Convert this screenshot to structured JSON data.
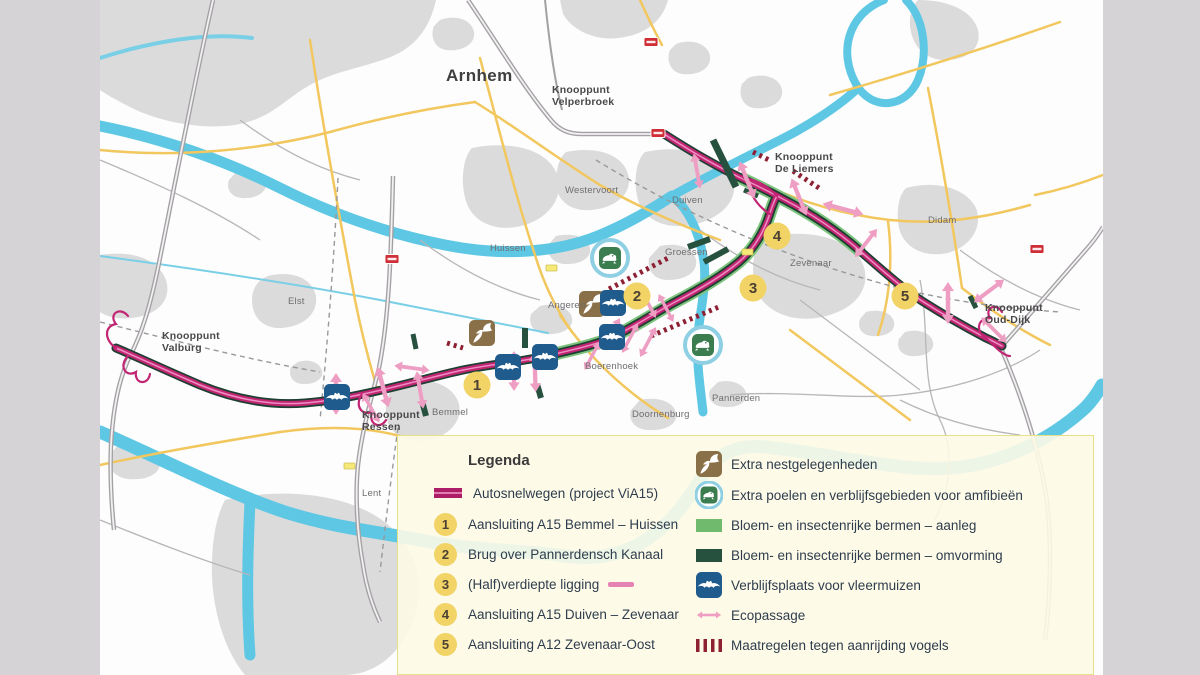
{
  "map": {
    "city": "Arnhem",
    "knooppunten": {
      "velperbroek": {
        "l1": "Knooppunt",
        "l2": "Velperbroek"
      },
      "deliemers": {
        "l1": "Knooppunt",
        "l2": "De Liemers"
      },
      "ouddijk": {
        "l1": "Knooppunt",
        "l2": "Oud-Dijk"
      },
      "valburg": {
        "l1": "Knooppunt",
        "l2": "Valburg"
      },
      "ressen": {
        "l1": "Knooppunt",
        "l2": "Ressen"
      }
    },
    "towns": {
      "elst": "Elst",
      "huissen": "Huissen",
      "westervoort": "Westervoort",
      "duiven": "Duiven",
      "groessen": "Groessen",
      "zevenaar": "Zevenaar",
      "didam": "Didam",
      "angeren": "Angeren",
      "boerenhoek": "Boerenhoek",
      "bemmel": "Bemmel",
      "doornenburg": "Doornenburg",
      "pannerden": "Pannerden",
      "lent": "Lent"
    },
    "markers": [
      "1",
      "2",
      "3",
      "4",
      "5"
    ]
  },
  "legend": {
    "title": "Legenda",
    "items_left": [
      {
        "num": "",
        "icon": "highway-line-icon",
        "label": "Autosnelwegen (project ViA15)"
      },
      {
        "num": "1",
        "label": "Aansluiting A15 Bemmel – Huissen"
      },
      {
        "num": "2",
        "label": "Brug over Pannerdensch Kanaal"
      },
      {
        "num": "3",
        "icon": "pink-line-icon",
        "label": "(Half)verdiepte ligging"
      },
      {
        "num": "4",
        "label": "Aansluiting A15 Duiven – Zevenaar"
      },
      {
        "num": "5",
        "label": "Aansluiting A12 Zevenaar-Oost"
      }
    ],
    "items_right": [
      {
        "icon": "swallow-icon",
        "label": "Extra nestgelegenheden"
      },
      {
        "icon": "frog-icon",
        "label": "Extra poelen en verblijfsgebieden voor amfibieën"
      },
      {
        "icon": "green-light-icon",
        "label": "Bloem- en insectenrijke bermen – aanleg"
      },
      {
        "icon": "green-dark-icon",
        "label": "Bloem- en insectenrijke bermen – omvorming"
      },
      {
        "icon": "bat-icon",
        "label": "Verblijfsplaats voor vleermuizen"
      },
      {
        "icon": "eco-arrow-icon",
        "label": "Ecopassage"
      },
      {
        "icon": "red-dashes-icon",
        "label": "Maatregelen tegen aanrijding vogels"
      }
    ]
  },
  "colors": {
    "highway_magenta": "#c22573",
    "highway_casing": "#1d3f31",
    "berm_aanleg": "#6fba6d",
    "berm_omvorming": "#27513f",
    "ecopassage_pink": "#ee9ec3",
    "bird_measure_red": "#8e2033",
    "water": "#5ec8e4",
    "road_yellow": "#f1c75e",
    "marker_yellow": "#f2d365",
    "nest_brown": "#8a7049",
    "bat_blue": "#1f5b8d",
    "frog_green": "#3c7d4f",
    "amphibian_ring": "#8ecfe4",
    "legend_bg": "#fdfae6"
  }
}
